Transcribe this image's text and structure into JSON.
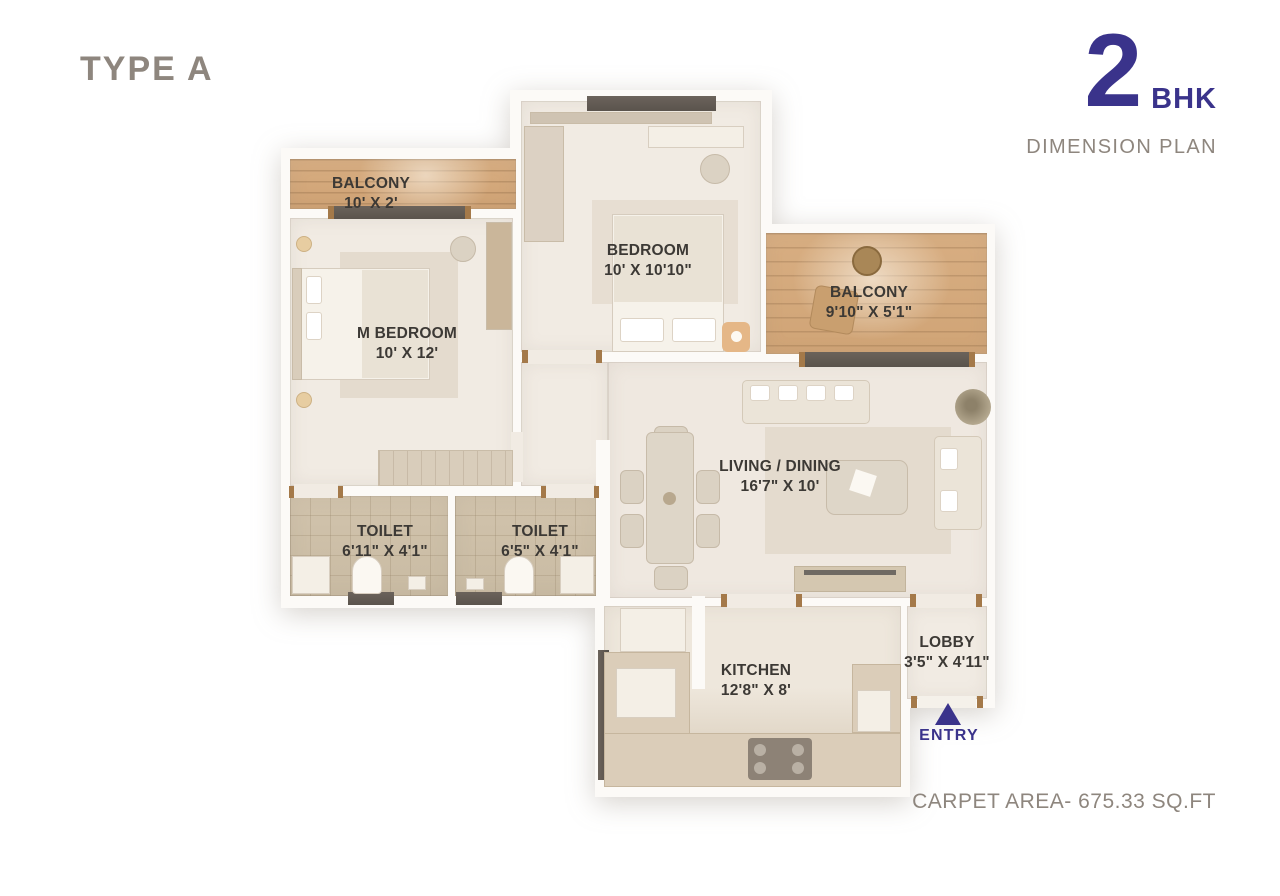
{
  "header": {
    "type_label": "TYPE A",
    "bhk_number": "2",
    "bhk_suffix": "BHK",
    "subtitle": "DIMENSION PLAN"
  },
  "footer": {
    "carpet_area": "CARPET AREA- 675.33 SQ.FT"
  },
  "entry": {
    "label": "ENTRY"
  },
  "colors": {
    "accent_indigo": "#3a338b",
    "muted_gray": "#8e867e",
    "label_dark": "#3c3935",
    "wood": "#d3a97c",
    "tile": "#cdbfa8",
    "floor_cream": "#f1ebe3"
  },
  "rooms": [
    {
      "id": "balcony-top",
      "name": "BALCONY",
      "dims": "10' X 2'"
    },
    {
      "id": "m-bedroom",
      "name": "M BEDROOM",
      "dims": "10' X 12'"
    },
    {
      "id": "bedroom",
      "name": "BEDROOM",
      "dims": "10' X 10'10\""
    },
    {
      "id": "balcony-right",
      "name": "BALCONY",
      "dims": "9'10\" X 5'1\""
    },
    {
      "id": "living-dining",
      "name": "LIVING / DINING",
      "dims": "16'7\" X 10'"
    },
    {
      "id": "toilet-1",
      "name": "TOILET",
      "dims": "6'11\" X 4'1\""
    },
    {
      "id": "toilet-2",
      "name": "TOILET",
      "dims": "6'5\" X 4'1\""
    },
    {
      "id": "kitchen",
      "name": "KITCHEN",
      "dims": "12'8\" X 8'"
    },
    {
      "id": "lobby",
      "name": "LOBBY",
      "dims": "3'5\" X 4'11\""
    }
  ]
}
